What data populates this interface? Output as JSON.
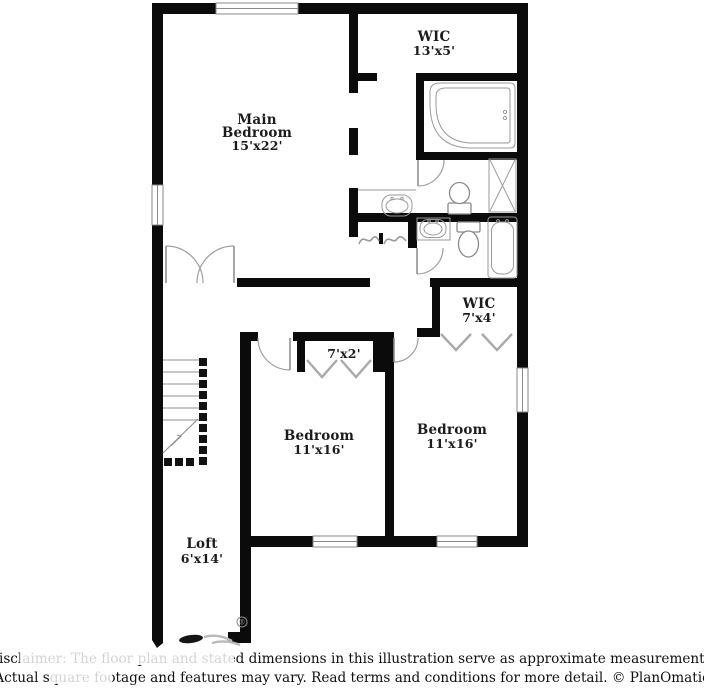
{
  "title": "Floor plan illustration",
  "colors": {
    "wall": "#0b0b0b",
    "background": "#ffffff",
    "fixture_line": "#8a8a8a"
  },
  "rooms": {
    "main_bedroom": {
      "line1": "Main",
      "line2": "Bedroom",
      "dims": "15'x22'"
    },
    "wic_top": {
      "name": "WIC",
      "dims": "13'x5'"
    },
    "wic_small": {
      "name": "WIC",
      "dims": "7'x4'"
    },
    "closet": {
      "dims": "7'x2'"
    },
    "bedroom_left": {
      "name": "Bedroom",
      "dims": "11'x16'"
    },
    "bedroom_right": {
      "name": "Bedroom",
      "dims": "11'x16'"
    },
    "loft": {
      "name": "Loft",
      "dims": "6'x14'"
    }
  },
  "watermark": {
    "registered": "®"
  },
  "disclaimer": {
    "line1": "Disclaimer: The floor plan and stated dimensions in this illustration serve as approximate measurements.",
    "line2": "Actual square footage and features may vary. Read terms and conditions for more detail. © PlanOmatic"
  }
}
